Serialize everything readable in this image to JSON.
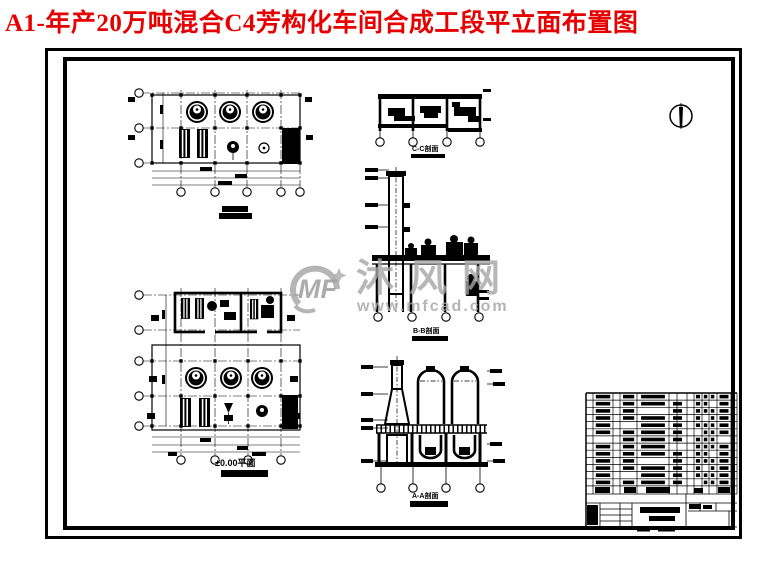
{
  "sheet": {
    "title": "A1-年产20万吨混合C4芳构化车间合成工段平立面布置图",
    "title_color": "#e60000",
    "paper_color": "#ffffff",
    "line_color": "#000000"
  },
  "labels": {
    "ground_plan": "±0.00平面",
    "section_cc": "C-C剖面",
    "section_bb": "B-B剖面",
    "section_aa": "A-A剖面"
  },
  "watermark": {
    "logo_text": "MF",
    "site_name": "沐风网",
    "site_url": "www.mfcad.com",
    "color": "#a6a6a6"
  },
  "symbols": {
    "north_arrow_icon": "compass-north-needle"
  }
}
